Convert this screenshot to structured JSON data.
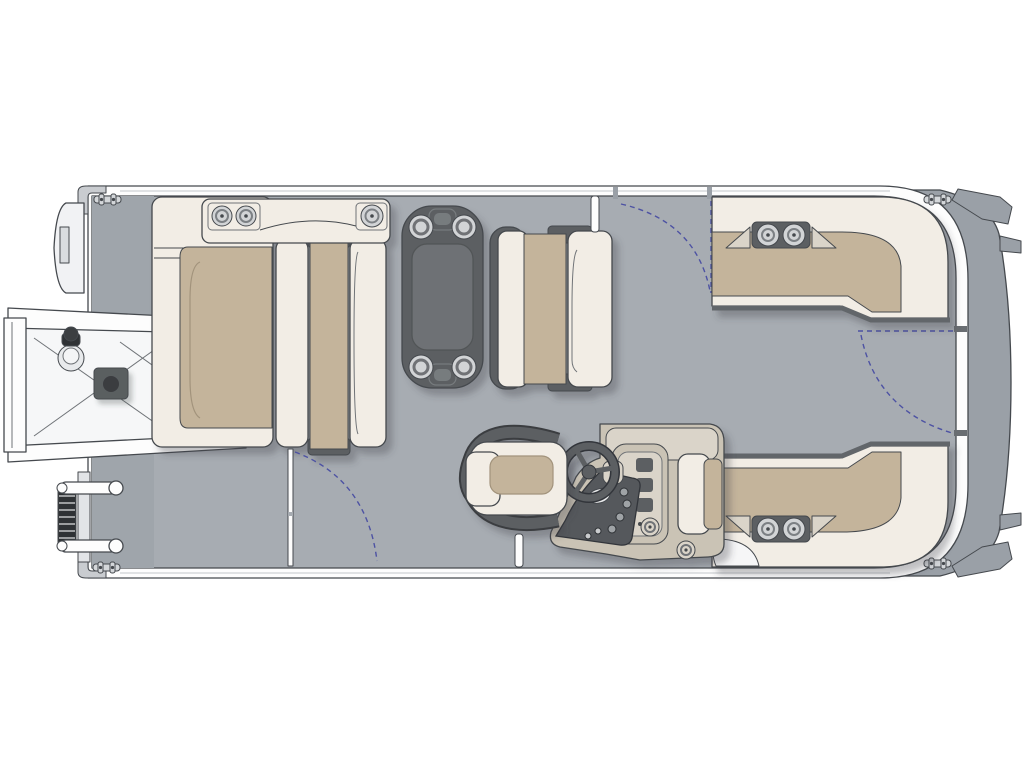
{
  "diagram": {
    "kind": "boat-floorplan",
    "view": "top-down",
    "orientation": "bow-left-stern-right",
    "colors": {
      "bg": "#ffffff",
      "deck": "#a7acb2",
      "deckdark": "#9fa5ab",
      "band": "#9aa0a7",
      "line": "#45494e",
      "soft": "#6f7377",
      "cream": "#f2ede5",
      "tan": "#c4b49b",
      "tandark": "#a2937b",
      "dark": "#5b5e62",
      "darker": "#3a3d41",
      "white": "#fdfdfd",
      "greige": "#cac3b5",
      "glight": "#dad4c9",
      "dash": "#4d52a3",
      "cup": "#d2d4d6",
      "panel": "#55585c",
      "steps": "#2f3235",
      "hatch": "#5a5e61"
    },
    "components": {
      "hull": {
        "label": "pontoon hull outline"
      },
      "gangway": {
        "label": "boarding ramp (bow, port side out)"
      },
      "bow_gate_door": {
        "label": "bow gate door"
      },
      "ladder": {
        "label": "folding boarding ladder"
      },
      "hatch": {
        "label": "deck storage hatch"
      },
      "bow_chaise": {
        "label": "bow chaise lounge"
      },
      "bow_bench": {
        "label": "bow facing bench"
      },
      "bow_console": {
        "label": "bow armrest console with cup holders"
      },
      "table": {
        "label": "removable pedestal table with four cup holders"
      },
      "mid_bench": {
        "label": "midship bench seat"
      },
      "seat_top_right": {
        "label": "starboard aft L-lounge (top)"
      },
      "seat_bottom_right": {
        "label": "starboard aft L-lounge (bottom)"
      },
      "helm": {
        "label": "helm console with gauge panel"
      },
      "wheel": {
        "label": "steering wheel"
      },
      "captain_chair": {
        "label": "captain's chair"
      },
      "gate_top": {
        "label": "side gate swing (top)"
      },
      "gate_port": {
        "label": "side gate swing (bottom left)"
      },
      "gate_stern": {
        "label": "stern gate swing"
      },
      "cleats": {
        "label": "mooring cleats (4)"
      }
    },
    "counts": {
      "cup_holders_bow_console": 3,
      "cup_holders_table": 4,
      "cup_holders_seats": 4,
      "cup_holders_helm": 2,
      "gates": 3,
      "cleats": 4
    }
  }
}
